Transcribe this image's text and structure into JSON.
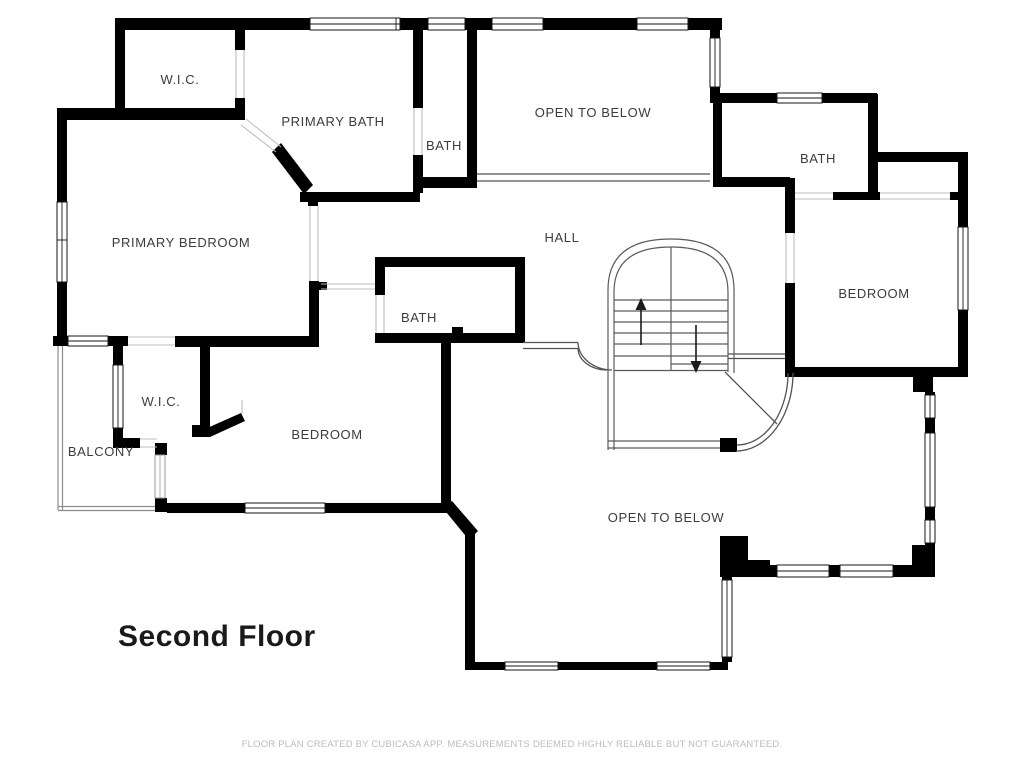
{
  "floor_plan": {
    "title": "Second Floor",
    "footer": "FLOOR PLAN CREATED BY CUBICASA APP. MEASUREMENTS DEEMED HIGHLY RELIABLE BUT NOT GUARANTEED.",
    "rooms": [
      {
        "id": "wic-upper",
        "label": "W.I.C."
      },
      {
        "id": "primary-bath",
        "label": "PRIMARY BATH"
      },
      {
        "id": "bath-top-center",
        "label": "BATH"
      },
      {
        "id": "open-to-below-top",
        "label": "OPEN TO BELOW"
      },
      {
        "id": "bath-top-right",
        "label": "BATH"
      },
      {
        "id": "primary-bedroom",
        "label": "PRIMARY BEDROOM"
      },
      {
        "id": "hall",
        "label": "HALL"
      },
      {
        "id": "bedroom-right",
        "label": "BEDROOM"
      },
      {
        "id": "bath-center",
        "label": "BATH"
      },
      {
        "id": "wic-lower",
        "label": "W.I.C."
      },
      {
        "id": "balcony",
        "label": "BALCONY"
      },
      {
        "id": "bedroom-bottom",
        "label": "BEDROOM"
      },
      {
        "id": "open-to-below-bottom",
        "label": "OPEN TO BELOW"
      }
    ],
    "stairs": {
      "up_icon": "up-arrow",
      "down_icon": "down-arrow"
    },
    "colors": {
      "wall": "#000000",
      "room_label": "#3c3c3c",
      "title": "#1a1a1a",
      "footer_text": "#bcbcbc",
      "railing": "#8c8c8c",
      "open_edge": "#525252",
      "background": "#ffffff"
    }
  }
}
